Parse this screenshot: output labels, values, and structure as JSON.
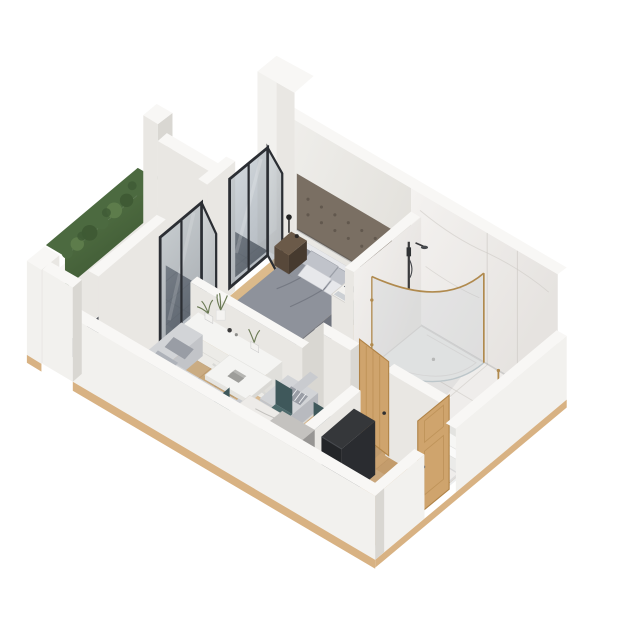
{
  "page": {
    "background": "#ffffff",
    "description": "Isometric 3D cutaway floor plan render of a one-bedroom apartment, no text labels"
  },
  "palette": {
    "bg": "#ffffff",
    "wallTop": "#f8f7f5",
    "wallBright": "#f2f1ee",
    "wallFace": "#e9e7e3",
    "wallShade": "#d9d7d2",
    "wallInnerA": "#f1f0ed",
    "wallInnerB": "#e3e1dc",
    "marbleA": "#f4f2f0",
    "marbleB": "#e6e3e0",
    "marbleVein": "#cdc9c5",
    "marbleFloor": "#efedeb",
    "woodA": "#e2c395",
    "woodB": "#c49a68",
    "woodLine": "#b98f60",
    "slabEdge": "#d8b283",
    "tileA": "#5f6268",
    "tileB": "#43464b",
    "tileLine": "#3a3d42",
    "hedgeA": "#5a7a4a",
    "hedgeB": "#3c5632",
    "hedgeLight": "#5d7c4b",
    "hedgeMid": "#4c6a40",
    "hedgeDark": "#3f5a34",
    "frame": "#2b2e33",
    "glassA": "#b3bec6",
    "glassB": "#76818d",
    "duvet": "#8e929b",
    "duvetSide": "#7d818b",
    "duvetDark": "#6f737d",
    "bedFrame": "#3c362f",
    "sheet": "#e7e8eb",
    "pillowGray": "#c0c3ca",
    "headboard": "#7a6f63",
    "tuft": "#5e554b",
    "nightTop": "#6b5a49",
    "nightFront": "#57483a",
    "nightSide": "#463a2f",
    "sofa": "#d2d4d7",
    "sofaShade": "#c2c4c8",
    "sofaBack": "#c9cbcf",
    "pillow1": "#999da5",
    "pillow2": "#aeb2b9",
    "white": "#f4f4f2",
    "whiteShade": "#e5e4e0",
    "teal": "#4d6a6c",
    "tealDark": "#3f585b",
    "chairLeg": "#2e3437",
    "tableMarble": "#edebe8",
    "tableEdge": "#dbd9d6",
    "legBrown": "#7a5a3e",
    "counter": "#c4c2bf",
    "counterFront": "#a9a7a5",
    "counterSide": "#979593",
    "black1": "#232528",
    "black2": "#35373a",
    "blackSide": "#2a2c30",
    "doorWood": "#cfa46d",
    "doorWoodDark": "#b08347",
    "gold": "#b08a4e",
    "fixture": "#3a3a3c",
    "tub": "#f6f6f4",
    "tubInner": "#e3e3e0",
    "towel": "#fafaf9",
    "plantGreen": "#6b7a55",
    "chairWoodSeat": "#8a5c38",
    "chairWoodBack": "#7a5232",
    "shadow": "#1c2430"
  },
  "scene": {
    "view": "isometric-cutaway",
    "subject": "one-bedroom apartment 3D floor plan",
    "rooms": [
      {
        "name": "balcony",
        "floor": "dark tile",
        "items": [
          "green hedge on parapet",
          "white column",
          "tall corner wall",
          "wooden chair"
        ]
      },
      {
        "name": "bedroom",
        "floor": "oak planks",
        "items": [
          "double bed with gray bedding",
          "tufted headboard wall panel",
          "nightstand with lamp",
          "nightstand with picture frames",
          "open wardrobe with folded clothes",
          "glass balcony door"
        ]
      },
      {
        "name": "living-room",
        "floor": "oak planks",
        "items": [
          "corner sofa with cushions",
          "white x-leg coffee table",
          "lounge armchair with striped pillow",
          "white tv console with plants",
          "glass balcony door"
        ]
      },
      {
        "name": "dining-area",
        "floor": "oak planks",
        "items": [
          "marble-top dining table",
          "teal dining chairs"
        ]
      },
      {
        "name": "kitchen-entry",
        "floor": "oak planks",
        "items": [
          "gray kitchen counter",
          "black cabinet unit",
          "wooden entry door"
        ]
      },
      {
        "name": "bathroom",
        "floor": "marble tile",
        "items": [
          "corner shower with curved gold-trim glass",
          "handheld shower on rail",
          "bathtub",
          "wooden towel ladder",
          "wooden bathroom door"
        ]
      }
    ]
  }
}
